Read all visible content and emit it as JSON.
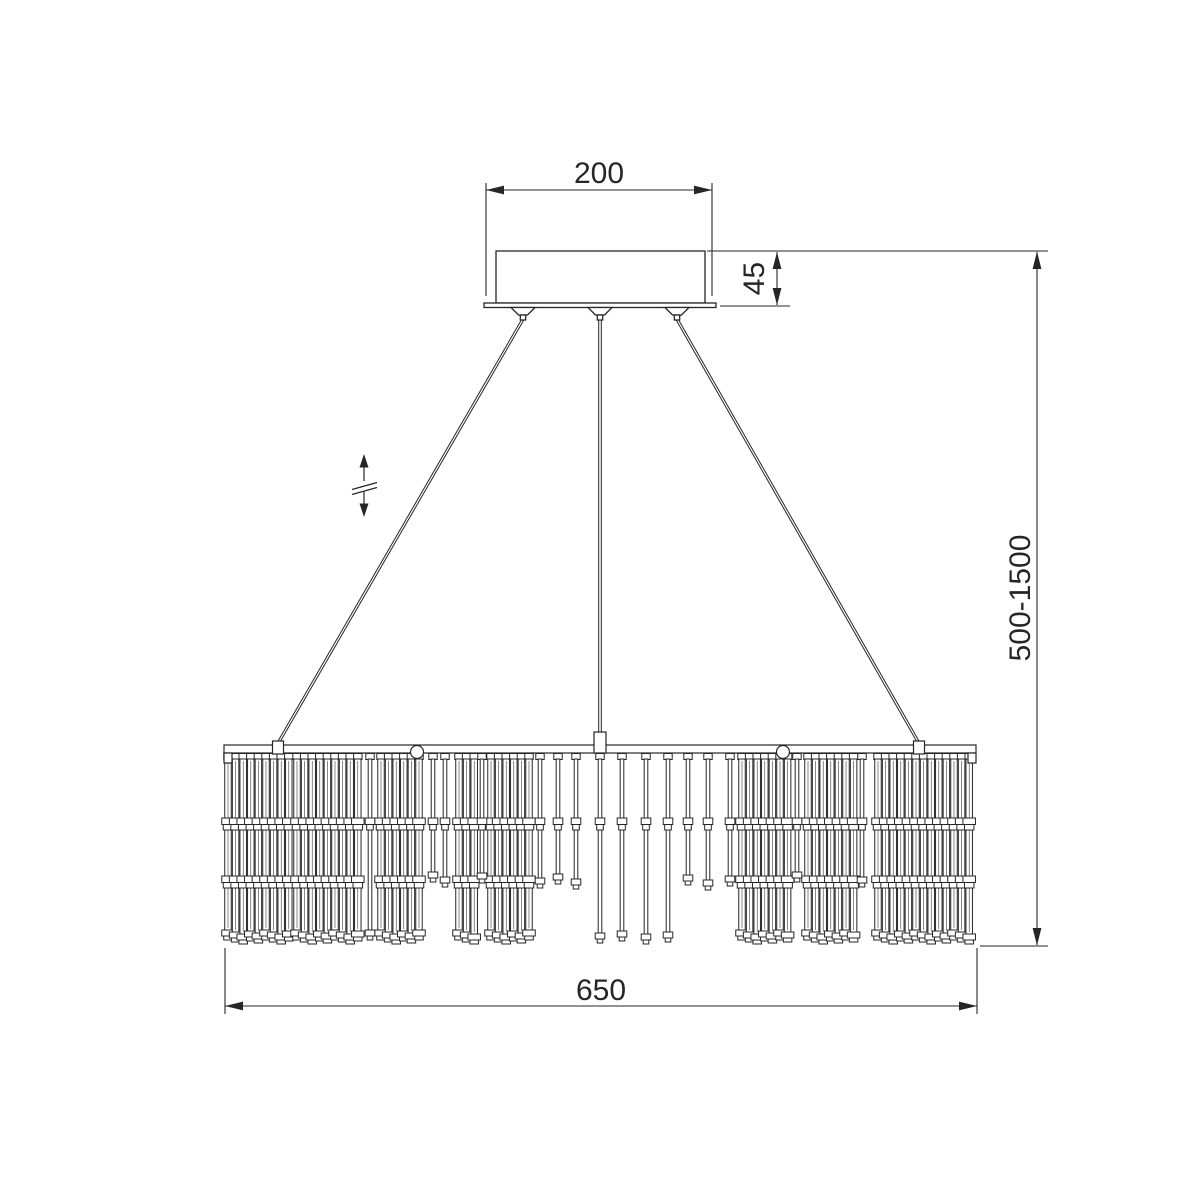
{
  "page": {
    "background": "#ffffff",
    "line_color": "#262626"
  },
  "dimensions": {
    "canopy_width": "200",
    "canopy_height": "45",
    "suspension_height_range": "500-1500",
    "fixture_width": "650"
  },
  "icons": {
    "height_adjust": "double-vertical-arrow-with-break"
  },
  "figure": {
    "stroke": "#262626",
    "rods": {
      "top_y": 753.5,
      "tube_top": 759,
      "collar_y": 818,
      "mid_y": 876,
      "short_end": 876,
      "long_end": 932,
      "thick_w": 6.5,
      "thin_w": 3.6,
      "clusters": [
        {
          "x": 228,
          "n": 9,
          "pitch": 7.6,
          "w": 6.5
        },
        {
          "x": 297,
          "n": 9,
          "pitch": 7.6,
          "w": 6.5
        },
        {
          "x": 381,
          "n": 6,
          "pitch": 7.6,
          "w": 6.5
        },
        {
          "x": 459,
          "n": 3,
          "pitch": 7.6,
          "w": 6.5
        },
        {
          "x": 491,
          "n": 6,
          "pitch": 7.6,
          "w": 6.5
        },
        {
          "x": 742,
          "n": 7,
          "pitch": 7.6,
          "w": 6.5
        },
        {
          "x": 808,
          "n": 7,
          "pitch": 7.6,
          "w": 6.5
        },
        {
          "x": 878,
          "n": 13,
          "pitch": 7.6,
          "w": 6.5
        }
      ],
      "singles_short": [
        433,
        445,
        482,
        540,
        558,
        576,
        688,
        708,
        730,
        797,
        862
      ],
      "singles_long": [
        370,
        600,
        622,
        646,
        668
      ]
    }
  }
}
